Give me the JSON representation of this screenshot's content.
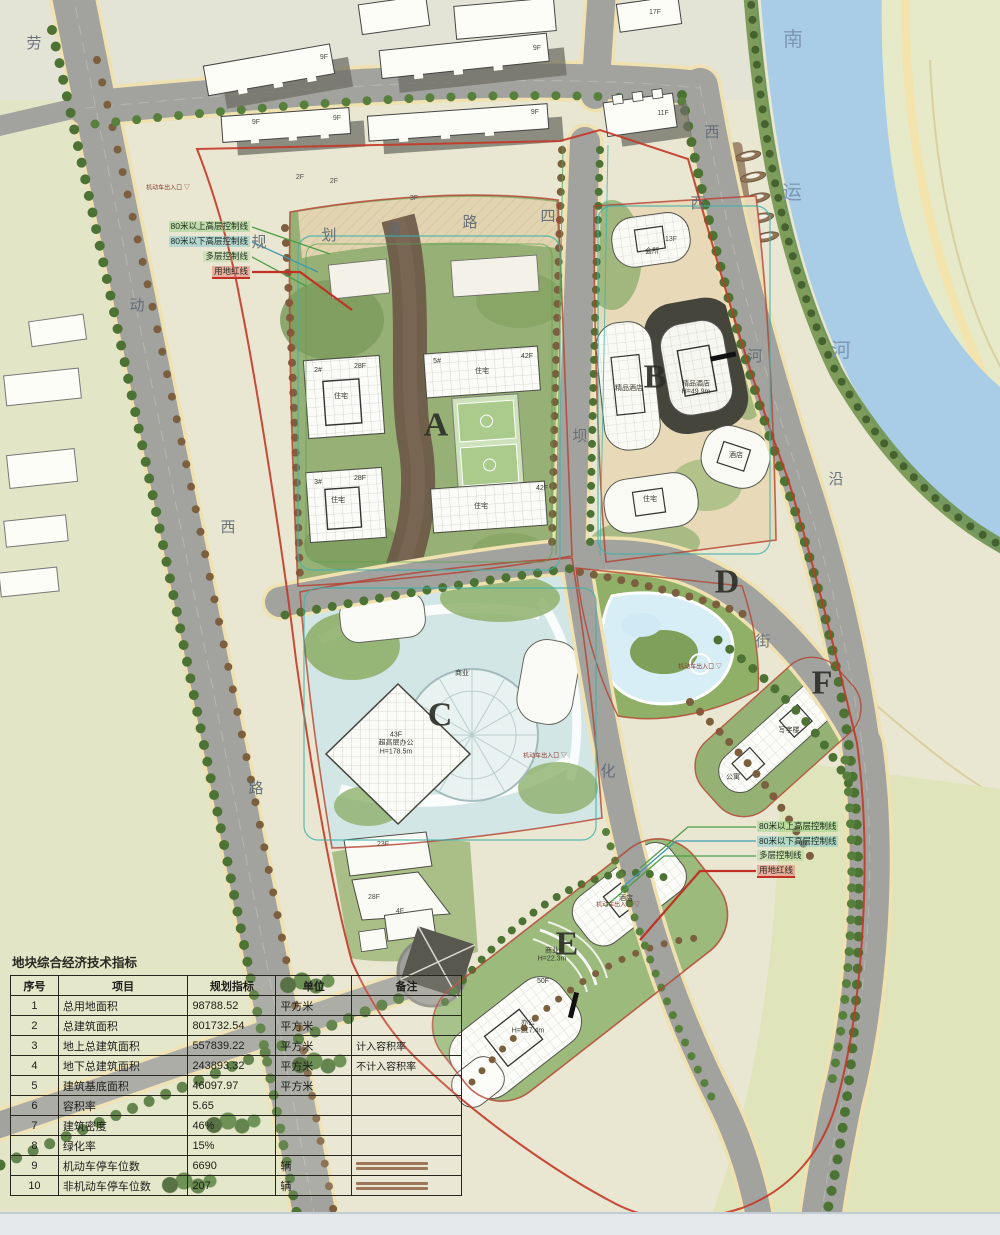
{
  "colors": {
    "river": "#a9cde6",
    "road": "#a2a29e",
    "road_edge": "#efe1b0",
    "site_green": "#97b075",
    "park": "#e4e9c6",
    "boundary_red": "#c43726",
    "control_green": "#4d9e45",
    "control_teal": "#3e9aae",
    "table_line": "#26261f"
  },
  "table": {
    "title": "地块综合经济技术指标",
    "headers": [
      "序号",
      "项目",
      "规划指标",
      "单位",
      "备注"
    ],
    "rows": [
      [
        "1",
        "总用地面积",
        "98788.52",
        "平方米",
        ""
      ],
      [
        "2",
        "总建筑面积",
        "801732.54",
        "平方米",
        ""
      ],
      [
        "3",
        "地上总建筑面积",
        "557839.22",
        "平方米",
        "计入容积率"
      ],
      [
        "4",
        "地下总建筑面积",
        "243893.32",
        "平方米",
        "不计入容积率"
      ],
      [
        "5",
        "建筑基底面积",
        "46097.97",
        "平方米",
        ""
      ],
      [
        "6",
        "容积率",
        "5.65",
        "",
        ""
      ],
      [
        "7",
        "建筑密度",
        "46%",
        "",
        ""
      ],
      [
        "8",
        "绿化率",
        "15%",
        "",
        ""
      ],
      [
        "9",
        "机动车停车位数",
        "6690",
        "辆",
        ""
      ],
      [
        "10",
        "非机动车停车位数",
        "207",
        "辆",
        ""
      ]
    ],
    "fine_print_rows": [
      8,
      9
    ]
  },
  "control_lines": {
    "items": [
      {
        "text": "80米以上高层控制线",
        "color": "#4d9e45",
        "bg": "rgba(150,210,130,0.5)"
      },
      {
        "text": "80米以下高层控制线",
        "color": "#3e9aae",
        "bg": "rgba(130,200,210,0.5)"
      },
      {
        "text": "多层控制线",
        "color": "#4d9e45",
        "bg": "rgba(150,210,130,0.3)"
      },
      {
        "text": "用地红线",
        "color": "#c03225",
        "bg": "rgba(235,130,120,0.55)"
      }
    ],
    "left": {
      "right_edge": 250,
      "top": 221,
      "line_height": 15
    },
    "right": {
      "left_edge": 757,
      "top": 821,
      "line_height": 14.5
    }
  },
  "labels": {
    "block-letter": [
      {
        "t": "A",
        "x": 436,
        "y": 426
      },
      {
        "t": "B",
        "x": 655,
        "y": 378
      },
      {
        "t": "C",
        "x": 440,
        "y": 716
      },
      {
        "t": "D",
        "x": 727,
        "y": 583
      },
      {
        "t": "E",
        "x": 567,
        "y": 945
      },
      {
        "t": "F",
        "x": 822,
        "y": 684
      }
    ],
    "water-ch": [
      {
        "t": "南",
        "x": 793,
        "y": 40
      },
      {
        "t": "运",
        "x": 792,
        "y": 193
      },
      {
        "t": "河",
        "x": 841,
        "y": 351
      }
    ],
    "road-ch": [
      {
        "t": "劳",
        "x": 34,
        "y": 44
      },
      {
        "t": "动",
        "x": 137,
        "y": 306
      },
      {
        "t": "西",
        "x": 228,
        "y": 528
      },
      {
        "t": "路",
        "x": 256,
        "y": 789
      },
      {
        "t": "西",
        "x": 712,
        "y": 133
      },
      {
        "t": "西",
        "x": 698,
        "y": 204
      },
      {
        "t": "河",
        "x": 755,
        "y": 357
      },
      {
        "t": "沿",
        "x": 836,
        "y": 480
      },
      {
        "t": "街",
        "x": 763,
        "y": 642
      },
      {
        "t": "规",
        "x": 259,
        "y": 243
      },
      {
        "t": "划",
        "x": 329,
        "y": 236
      },
      {
        "t": "道",
        "x": 394,
        "y": 230
      },
      {
        "t": "路",
        "x": 470,
        "y": 223
      },
      {
        "t": "四",
        "x": 548,
        "y": 217
      },
      {
        "t": "坝",
        "x": 580,
        "y": 437
      },
      {
        "t": "化",
        "x": 608,
        "y": 772
      }
    ],
    "floor-lb": [
      {
        "t": "9F",
        "x": 324,
        "y": 58
      },
      {
        "t": "9F",
        "x": 537,
        "y": 49
      },
      {
        "t": "9F",
        "x": 256,
        "y": 123
      },
      {
        "t": "9F",
        "x": 337,
        "y": 119
      },
      {
        "t": "9F",
        "x": 535,
        "y": 113
      },
      {
        "t": "11F",
        "x": 663,
        "y": 114
      },
      {
        "t": "17F",
        "x": 655,
        "y": 13
      },
      {
        "t": "2F",
        "x": 300,
        "y": 178
      },
      {
        "t": "2F",
        "x": 334,
        "y": 182
      },
      {
        "t": "3F",
        "x": 414,
        "y": 199
      },
      {
        "t": "13F",
        "x": 671,
        "y": 240
      },
      {
        "t": "23F",
        "x": 383,
        "y": 845
      },
      {
        "t": "28F",
        "x": 374,
        "y": 898
      },
      {
        "t": "4F",
        "x": 400,
        "y": 912
      }
    ],
    "bldg-lb": [
      {
        "t": "2#",
        "x": 318,
        "y": 371
      },
      {
        "t": "28F",
        "x": 360,
        "y": 367
      },
      {
        "t": "住宅",
        "x": 341,
        "y": 397
      },
      {
        "t": "3#",
        "x": 318,
        "y": 483
      },
      {
        "t": "28F",
        "x": 360,
        "y": 479
      },
      {
        "t": "住宅",
        "x": 338,
        "y": 501
      },
      {
        "t": "5#",
        "x": 437,
        "y": 362
      },
      {
        "t": "42F",
        "x": 527,
        "y": 357
      },
      {
        "t": "住宅",
        "x": 482,
        "y": 372
      },
      {
        "t": "42F",
        "x": 542,
        "y": 489
      },
      {
        "t": "住宅",
        "x": 481,
        "y": 507
      },
      {
        "t": "精品酒店",
        "x": 629,
        "y": 389
      },
      {
        "t": "精品酒店\nH=49.9m",
        "x": 696,
        "y": 389
      },
      {
        "t": "酒店",
        "x": 736,
        "y": 456
      },
      {
        "t": "会所",
        "x": 652,
        "y": 252
      },
      {
        "t": "住宅",
        "x": 650,
        "y": 500
      },
      {
        "t": "43F\n超高层办公\nH=178.5m",
        "x": 396,
        "y": 744
      },
      {
        "t": "商业",
        "x": 462,
        "y": 674
      },
      {
        "t": "酒店",
        "x": 626,
        "y": 899
      },
      {
        "t": "商业\nH=22.3m",
        "x": 552,
        "y": 956
      },
      {
        "t": "50F",
        "x": 543,
        "y": 982
      },
      {
        "t": "办公\nH=217.4m",
        "x": 528,
        "y": 1028
      },
      {
        "t": "写字楼",
        "x": 789,
        "y": 731
      },
      {
        "t": "公寓",
        "x": 733,
        "y": 778
      }
    ],
    "ent-lb": [
      {
        "t": "机动车出入口",
        "x": 168,
        "y": 189
      },
      {
        "t": "机动车出入口",
        "x": 545,
        "y": 757
      },
      {
        "t": "机动车出入口",
        "x": 700,
        "y": 668
      },
      {
        "t": "机动车出入口",
        "x": 618,
        "y": 906
      }
    ]
  }
}
